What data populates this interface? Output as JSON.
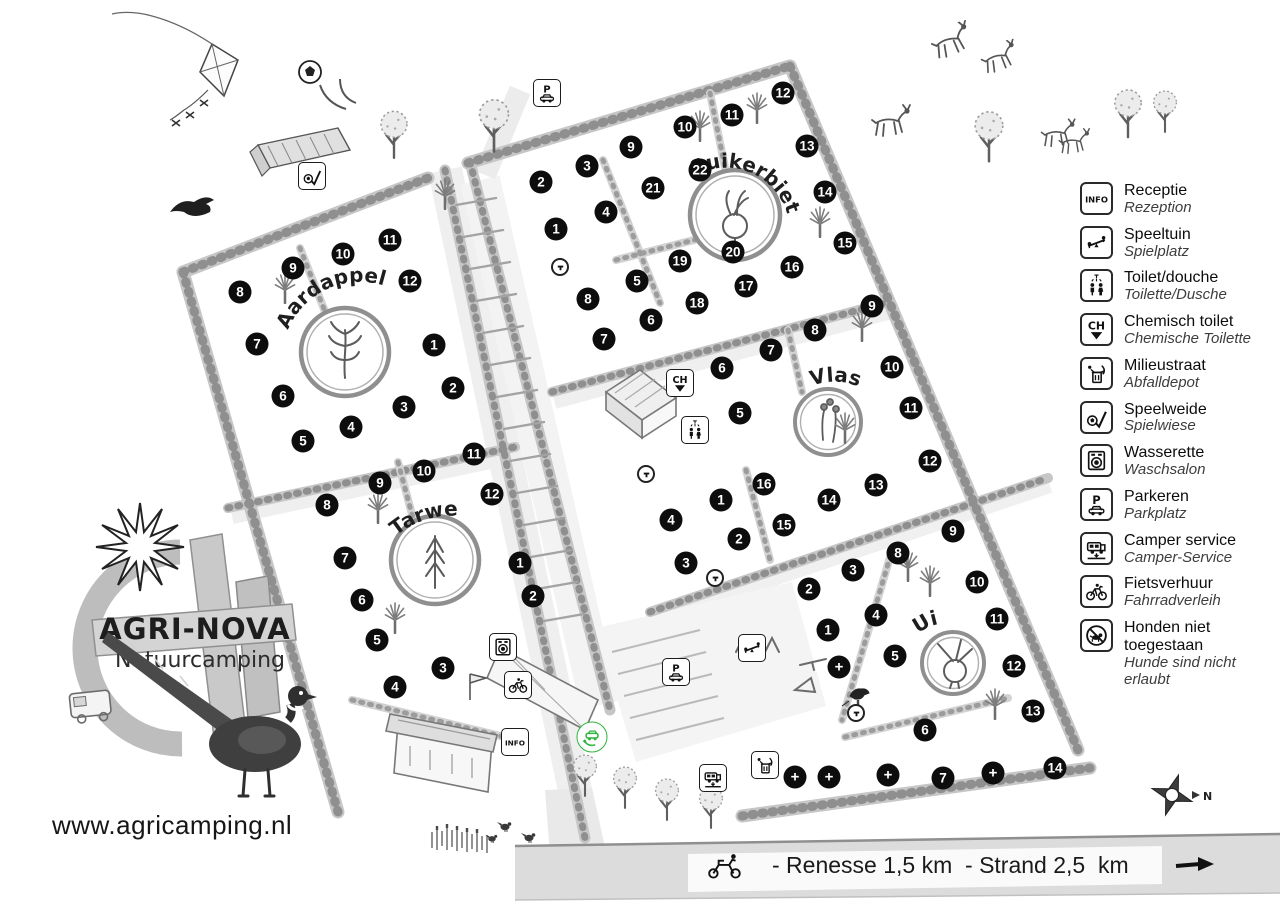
{
  "site": {
    "title": "AGRI-NOVA",
    "subtitle": "Natuurcamping",
    "website": "www.agricamping.nl",
    "road_label": "- Renesse 1,5 km  - Strand 2,5  km",
    "compass_label": "N"
  },
  "icon_labels": {
    "info": "INFO",
    "parking": "P",
    "chemical": "CH"
  },
  "fields": [
    {
      "name": "Aardappel",
      "pitches": [
        {
          "n": "1",
          "x": 434,
          "y": 345
        },
        {
          "n": "2",
          "x": 453,
          "y": 388
        },
        {
          "n": "3",
          "x": 404,
          "y": 407
        },
        {
          "n": "4",
          "x": 351,
          "y": 427
        },
        {
          "n": "5",
          "x": 303,
          "y": 441
        },
        {
          "n": "6",
          "x": 283,
          "y": 396
        },
        {
          "n": "7",
          "x": 257,
          "y": 344
        },
        {
          "n": "8",
          "x": 240,
          "y": 292
        },
        {
          "n": "9",
          "x": 293,
          "y": 268
        },
        {
          "n": "10",
          "x": 343,
          "y": 254
        },
        {
          "n": "11",
          "x": 390,
          "y": 240
        },
        {
          "n": "12",
          "x": 410,
          "y": 281
        }
      ]
    },
    {
      "name": "Tarwe",
      "pitches": [
        {
          "n": "1",
          "x": 520,
          "y": 563
        },
        {
          "n": "2",
          "x": 533,
          "y": 596
        },
        {
          "n": "3",
          "x": 443,
          "y": 668
        },
        {
          "n": "4",
          "x": 395,
          "y": 687
        },
        {
          "n": "5",
          "x": 377,
          "y": 640
        },
        {
          "n": "6",
          "x": 362,
          "y": 600
        },
        {
          "n": "7",
          "x": 345,
          "y": 558
        },
        {
          "n": "8",
          "x": 327,
          "y": 505
        },
        {
          "n": "9",
          "x": 380,
          "y": 483
        },
        {
          "n": "10",
          "x": 424,
          "y": 471
        },
        {
          "n": "11",
          "x": 474,
          "y": 454
        },
        {
          "n": "12",
          "x": 492,
          "y": 494
        }
      ]
    },
    {
      "name": "Suikerbiet",
      "pitches": [
        {
          "n": "1",
          "x": 556,
          "y": 229
        },
        {
          "n": "2",
          "x": 541,
          "y": 182
        },
        {
          "n": "3",
          "x": 587,
          "y": 166
        },
        {
          "n": "4",
          "x": 606,
          "y": 212
        },
        {
          "n": "5",
          "x": 637,
          "y": 281
        },
        {
          "n": "6",
          "x": 651,
          "y": 320
        },
        {
          "n": "7",
          "x": 604,
          "y": 339
        },
        {
          "n": "8",
          "x": 588,
          "y": 299
        },
        {
          "n": "9",
          "x": 631,
          "y": 147
        },
        {
          "n": "10",
          "x": 685,
          "y": 127
        },
        {
          "n": "11",
          "x": 732,
          "y": 115
        },
        {
          "n": "12",
          "x": 783,
          "y": 93
        },
        {
          "n": "13",
          "x": 807,
          "y": 146
        },
        {
          "n": "14",
          "x": 825,
          "y": 192
        },
        {
          "n": "15",
          "x": 845,
          "y": 243
        },
        {
          "n": "16",
          "x": 792,
          "y": 267
        },
        {
          "n": "17",
          "x": 746,
          "y": 286
        },
        {
          "n": "18",
          "x": 697,
          "y": 303
        },
        {
          "n": "19",
          "x": 680,
          "y": 261
        },
        {
          "n": "20",
          "x": 733,
          "y": 252
        },
        {
          "n": "21",
          "x": 653,
          "y": 188
        },
        {
          "n": "22",
          "x": 700,
          "y": 170
        }
      ]
    },
    {
      "name": "Vlas",
      "pitches": [
        {
          "n": "1",
          "x": 721,
          "y": 500
        },
        {
          "n": "2",
          "x": 739,
          "y": 539
        },
        {
          "n": "3",
          "x": 686,
          "y": 563
        },
        {
          "n": "4",
          "x": 671,
          "y": 520
        },
        {
          "n": "5",
          "x": 740,
          "y": 413
        },
        {
          "n": "6",
          "x": 722,
          "y": 368
        },
        {
          "n": "7",
          "x": 771,
          "y": 350
        },
        {
          "n": "8",
          "x": 815,
          "y": 330
        },
        {
          "n": "9",
          "x": 872,
          "y": 306
        },
        {
          "n": "10",
          "x": 892,
          "y": 367
        },
        {
          "n": "11",
          "x": 911,
          "y": 408
        },
        {
          "n": "12",
          "x": 930,
          "y": 461
        },
        {
          "n": "13",
          "x": 876,
          "y": 485
        },
        {
          "n": "14",
          "x": 829,
          "y": 500
        },
        {
          "n": "15",
          "x": 784,
          "y": 525
        },
        {
          "n": "16",
          "x": 764,
          "y": 484
        }
      ]
    },
    {
      "name": "Ui",
      "pitches": [
        {
          "n": "1",
          "x": 828,
          "y": 630
        },
        {
          "n": "2",
          "x": 809,
          "y": 589
        },
        {
          "n": "3",
          "x": 853,
          "y": 570
        },
        {
          "n": "4",
          "x": 876,
          "y": 615
        },
        {
          "n": "5",
          "x": 895,
          "y": 656
        },
        {
          "n": "6",
          "x": 925,
          "y": 730
        },
        {
          "n": "7",
          "x": 943,
          "y": 778
        },
        {
          "n": "8",
          "x": 898,
          "y": 553
        },
        {
          "n": "9",
          "x": 953,
          "y": 531
        },
        {
          "n": "10",
          "x": 977,
          "y": 582
        },
        {
          "n": "11",
          "x": 997,
          "y": 619
        },
        {
          "n": "12",
          "x": 1014,
          "y": 666
        },
        {
          "n": "13",
          "x": 1033,
          "y": 711
        },
        {
          "n": "14",
          "x": 1055,
          "y": 768
        }
      ]
    }
  ],
  "extra_pitch_markers": [
    {
      "label": "+",
      "x": 839,
      "y": 667
    },
    {
      "label": "+",
      "x": 795,
      "y": 777
    },
    {
      "label": "+",
      "x": 829,
      "y": 777
    },
    {
      "label": "+",
      "x": 888,
      "y": 775
    },
    {
      "label": "+",
      "x": 993,
      "y": 773
    }
  ],
  "water_points": [
    {
      "x": 560,
      "y": 267
    },
    {
      "x": 646,
      "y": 474
    },
    {
      "x": 715,
      "y": 578
    },
    {
      "x": 856,
      "y": 713
    }
  ],
  "facilities": [
    {
      "icon": "parking-icon",
      "x": 547,
      "y": 93
    },
    {
      "icon": "speelweide-icon",
      "x": 312,
      "y": 176
    },
    {
      "icon": "ch-toilet-icon",
      "x": 680,
      "y": 383
    },
    {
      "icon": "toilet-icon",
      "x": 695,
      "y": 430
    },
    {
      "icon": "wasserette-icon",
      "x": 503,
      "y": 647
    },
    {
      "icon": "fietsverhuur-icon",
      "x": 518,
      "y": 685
    },
    {
      "icon": "info-icon",
      "x": 515,
      "y": 742
    },
    {
      "icon": "ev-charge-icon",
      "x": 592,
      "y": 737,
      "shape": "round",
      "color": "#2eb33c"
    },
    {
      "icon": "parking-icon",
      "x": 676,
      "y": 672
    },
    {
      "icon": "speeltuin-icon",
      "x": 752,
      "y": 648
    },
    {
      "icon": "camper-icon",
      "x": 713,
      "y": 778
    },
    {
      "icon": "milieustraat-icon",
      "x": 765,
      "y": 765
    }
  ],
  "legend": {
    "items": [
      {
        "icon": "info-icon",
        "nl": "Receptie",
        "de": "Rezeption"
      },
      {
        "icon": "speeltuin-icon",
        "nl": "Speeltuin",
        "de": "Spielplatz"
      },
      {
        "icon": "toilet-icon",
        "nl": "Toilet/douche",
        "de": "Toilette/Dusche"
      },
      {
        "icon": "ch-toilet-icon",
        "nl": "Chemisch toilet",
        "de": "Chemische Toilette"
      },
      {
        "icon": "milieustraat-icon",
        "nl": "Milieustraat",
        "de": "Abfalldepot"
      },
      {
        "icon": "speelweide-icon",
        "nl": "Speelweide",
        "de": "Spielwiese"
      },
      {
        "icon": "wasserette-icon",
        "nl": "Wasserette",
        "de": "Waschsalon"
      },
      {
        "icon": "parking-icon",
        "nl": "Parkeren",
        "de": "Parkplatz"
      },
      {
        "icon": "camper-icon",
        "nl": "Camper service",
        "de": "Camper-Service"
      },
      {
        "icon": "fietsverhuur-icon",
        "nl": "Fietsverhuur",
        "de": "Fahrradverleih"
      },
      {
        "icon": "no-dogs-icon",
        "nl": "Honden niet toegestaan",
        "de": "Hunde sind nicht erlaubt"
      }
    ]
  }
}
